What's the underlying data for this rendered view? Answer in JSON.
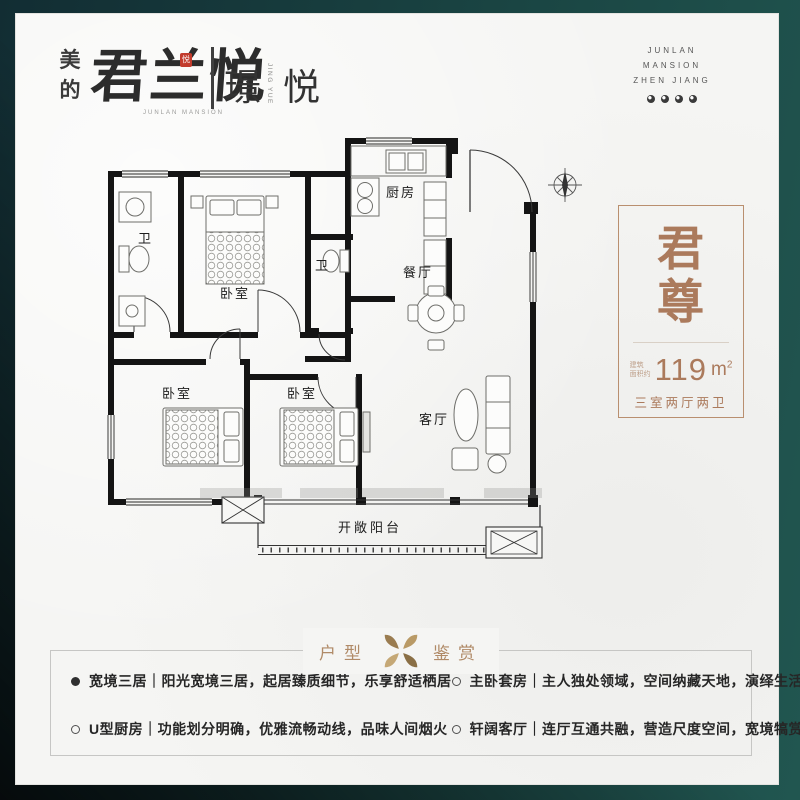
{
  "colors": {
    "frame_teal": "#1a4543",
    "card_bg": "#f5f5f3",
    "accent_brown": "#ab7a5c",
    "panel_border": "#b98f6f",
    "section_gold": "#b08a67",
    "seal_red": "#c23b2d",
    "wall_black": "#141414"
  },
  "header": {
    "midea_char_1": "美",
    "midea_char_2": "的",
    "logo_script": "君兰悦",
    "logo_seal_char": "悦",
    "logo_caption": "JUNLAN MANSION",
    "series_char_1": "璟",
    "series_caption": "JING YUE",
    "series_char_2": "悦",
    "corner_lines": [
      "JUNLAN",
      "MANSION",
      "ZHEN JIANG"
    ]
  },
  "floorplan": {
    "labels": {
      "kitchen": "厨房",
      "dining": "餐厅",
      "living": "客厅",
      "bath1": "卫",
      "bath2": "卫",
      "bedroom_top": "卧室",
      "bedroom_left": "卧室",
      "bedroom_mid": "卧室",
      "balcony": "开敞阳台"
    }
  },
  "info_panel": {
    "name_char_1": "君",
    "name_char_2": "尊",
    "area_label_line1": "建筑",
    "area_label_line2": "面积约",
    "area_value": "119",
    "area_unit_base": "m",
    "area_unit_sup": "2",
    "layout_text": "三室两厅两卫"
  },
  "section": {
    "title_left": "户型",
    "title_right": "鉴赏"
  },
  "features": [
    {
      "style": "filled",
      "text": "宽境三居｜阳光宽境三居，起居臻质细节，乐享舒适栖居"
    },
    {
      "style": "hollow",
      "text": "U型厨房｜功能划分明确，优雅流畅动线，品味人间烟火"
    },
    {
      "style": "hollow",
      "text": "主卧套房｜主人独处领域，空间纳藏天地，演绎生活格调"
    },
    {
      "style": "hollow",
      "text": "轩阔客厅｜连厅互通共融，营造尺度空间，宽境犒赏人生"
    }
  ]
}
